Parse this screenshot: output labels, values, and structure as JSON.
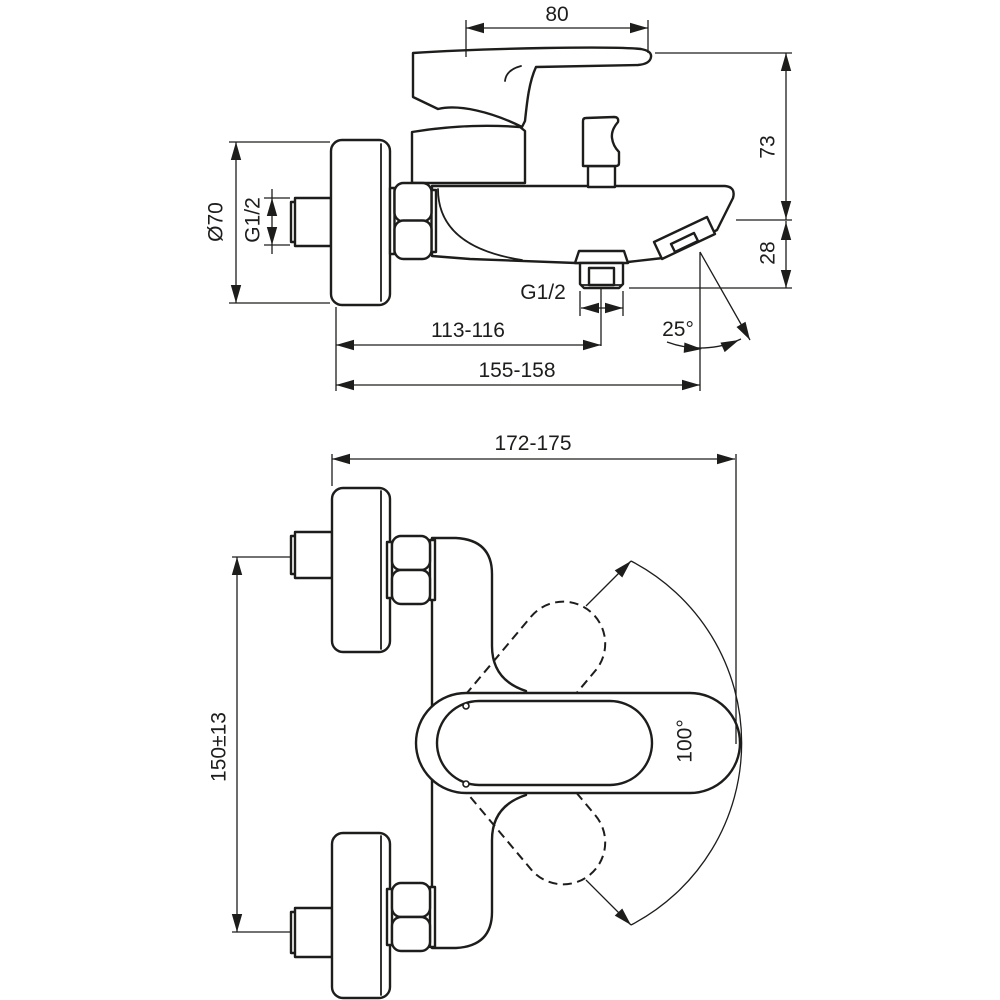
{
  "colors": {
    "background": "#ffffff",
    "line": "#1d1d1b"
  },
  "views": {
    "side": {
      "dims": {
        "handle_length": "80",
        "overall_height": "73",
        "spout_drop": "28",
        "flange_diameter": "Ø70",
        "wall_thread": "G1/2",
        "handshower_outlet_thread": "G1/2",
        "wall_to_handshower_outlet": "113-116",
        "wall_to_spout_outlet": "155-158",
        "spout_angle": "25°"
      }
    },
    "front": {
      "dims": {
        "overall_depth": "172-175",
        "inlet_spacing": "150±13",
        "handle_swing_angle": "100°"
      }
    }
  }
}
